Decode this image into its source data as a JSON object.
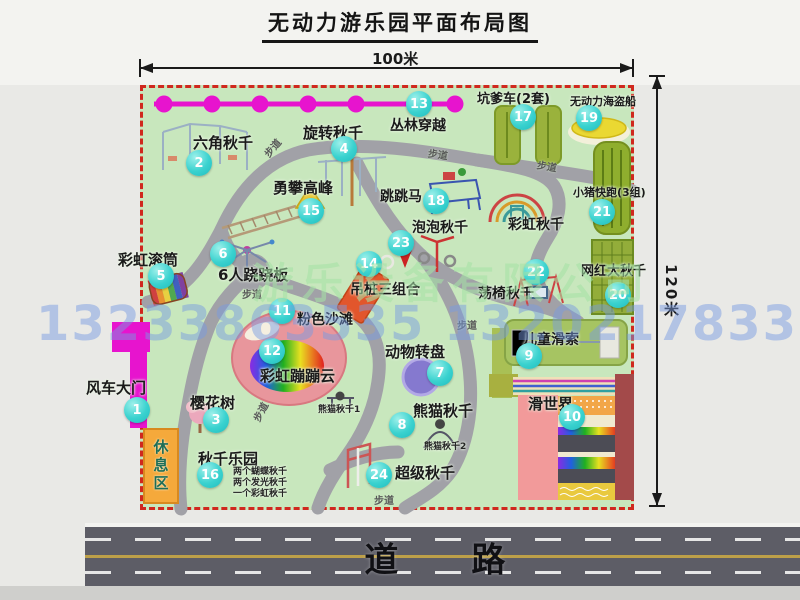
{
  "title": "无动力游乐园平面布局图",
  "scale": {
    "top": "100米",
    "right": "120米"
  },
  "road_label": "道 路",
  "rest_area_label": "休息区",
  "watermarks": {
    "company": "游乐设备有限公司",
    "phone": "13233863535 13202178333"
  },
  "colors": {
    "map_green": "#c8e7bd",
    "boundary_red": "#d0281e",
    "badge_teal": "#3ad2cf",
    "zipline_magenta": "#e714ce",
    "road_gray": "#5d5d66",
    "rest_orange": "#f5a93b"
  },
  "attractions": [
    {
      "num": "1",
      "name": "风车大门",
      "badge": [
        137,
        410
      ],
      "label": [
        86,
        381
      ],
      "fs": 15
    },
    {
      "num": "2",
      "name": "六角秋千",
      "badge": [
        199,
        163
      ],
      "label": [
        193,
        136
      ],
      "fs": 15
    },
    {
      "num": "3",
      "name": "樱花树",
      "badge": [
        216,
        420
      ],
      "label": [
        190,
        396
      ],
      "fs": 15
    },
    {
      "num": "4",
      "name": "旋转秋千",
      "badge": [
        344,
        149
      ],
      "label": [
        303,
        126
      ],
      "fs": 15
    },
    {
      "num": "5",
      "name": "彩虹滚筒",
      "badge": [
        161,
        276
      ],
      "label": [
        118,
        253
      ],
      "fs": 15
    },
    {
      "num": "6",
      "name": "6人跷跷板",
      "badge": [
        223,
        254
      ],
      "label": [
        218,
        268
      ],
      "fs": 15
    },
    {
      "num": "7",
      "name": "动物转盘",
      "badge": [
        440,
        373
      ],
      "label": [
        385,
        345
      ],
      "fs": 15
    },
    {
      "num": "8",
      "name": "熊猫秋千",
      "badge": [
        402,
        425
      ],
      "label": [
        413,
        404
      ],
      "fs": 15
    },
    {
      "num": "9",
      "name": "儿童滑索",
      "badge": [
        529,
        356
      ],
      "label": [
        523,
        333
      ],
      "fs": 14
    },
    {
      "num": "10",
      "name": "滑世界",
      "badge": [
        572,
        417
      ],
      "label": [
        528,
        397
      ],
      "fs": 15
    },
    {
      "num": "11",
      "name": "粉色沙滩",
      "badge": [
        282,
        311
      ],
      "label": [
        297,
        313
      ],
      "fs": 14
    },
    {
      "num": "12",
      "name": "彩虹蹦蹦云",
      "badge": [
        272,
        351
      ],
      "label": [
        260,
        369
      ],
      "fs": 15
    },
    {
      "num": "13",
      "name": "丛林穿越",
      "badge": [
        419,
        104
      ],
      "label": [
        390,
        119
      ],
      "fs": 14
    },
    {
      "num": "14",
      "name": "吊桩三组合",
      "badge": [
        369,
        264
      ],
      "label": [
        350,
        283
      ],
      "fs": 14
    },
    {
      "num": "15",
      "name": "勇攀高峰",
      "badge": [
        311,
        211
      ],
      "label": [
        273,
        181
      ],
      "fs": 15
    },
    {
      "num": "16",
      "name": "秋千乐园",
      "badge": [
        210,
        475
      ],
      "label": [
        198,
        452
      ],
      "fs": 15
    },
    {
      "num": "17",
      "name": "坑爹车(2套)",
      "badge": [
        523,
        117
      ],
      "label": [
        477,
        93
      ],
      "fs": 13
    },
    {
      "num": "18",
      "name": "跳跳马",
      "badge": [
        436,
        201
      ],
      "label": [
        380,
        190
      ],
      "fs": 14
    },
    {
      "num": "19",
      "name": "无动力海盗船",
      "badge": [
        589,
        118
      ],
      "label": [
        570,
        96
      ],
      "fs": 11
    },
    {
      "num": "20",
      "name": "网红大秋千",
      "badge": [
        618,
        295
      ],
      "label": [
        581,
        265
      ],
      "fs": 13
    },
    {
      "num": "21",
      "name": "小猪快跑(3组)",
      "badge": [
        602,
        212
      ],
      "label": [
        573,
        187
      ],
      "fs": 11
    },
    {
      "num": "22",
      "name": "荡椅秋千",
      "badge": [
        536,
        272
      ],
      "label": [
        478,
        287
      ],
      "fs": 14
    },
    {
      "num": "23",
      "name": "泡泡秋千",
      "badge": [
        401,
        243
      ],
      "label": [
        412,
        221
      ],
      "fs": 14
    },
    {
      "num": "24",
      "name": "超级秋千",
      "badge": [
        379,
        475
      ],
      "label": [
        395,
        466
      ],
      "fs": 15
    },
    {
      "num": "",
      "name": "彩虹秋千",
      "label": [
        508,
        218
      ],
      "fs": 14
    }
  ],
  "small_labels": [
    {
      "text": "熊猫秋千1",
      "pos": [
        318,
        406
      ]
    },
    {
      "text": "熊猫秋千2",
      "pos": [
        424,
        443
      ]
    },
    {
      "text": "两个蝴蝶秋千",
      "pos": [
        233,
        468
      ]
    },
    {
      "text": "两个发光秋千",
      "pos": [
        233,
        479
      ]
    },
    {
      "text": "一个彩虹秋千",
      "pos": [
        233,
        490
      ]
    }
  ],
  "path_labels": [
    {
      "text": "步道",
      "pos": [
        262,
        140
      ],
      "rot": -50
    },
    {
      "text": "步道",
      "pos": [
        428,
        146
      ],
      "rot": 8
    },
    {
      "text": "步道",
      "pos": [
        537,
        158
      ],
      "rot": 10
    },
    {
      "text": "步道",
      "pos": [
        242,
        286
      ],
      "rot": 0
    },
    {
      "text": "步道",
      "pos": [
        457,
        317
      ],
      "rot": 0
    },
    {
      "text": "步道",
      "pos": [
        250,
        404
      ],
      "rot": -62
    },
    {
      "text": "步道",
      "pos": [
        374,
        492
      ],
      "rot": 0
    }
  ]
}
